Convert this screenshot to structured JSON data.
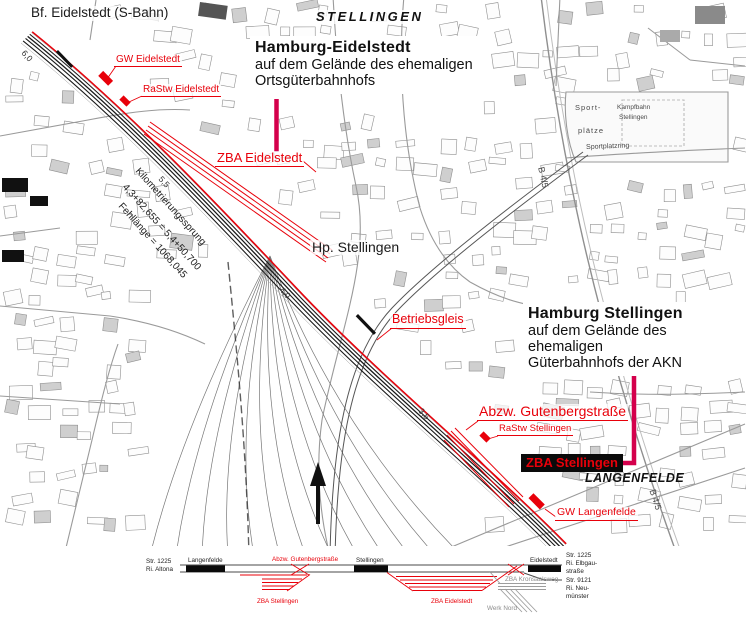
{
  "colors": {
    "red": "#e8000a",
    "crimson": "#d4004c",
    "black": "#1a1a1a",
    "gray": "#8c8c8c"
  },
  "map": {
    "region_labels": {
      "stellingen": "STELLINGEN",
      "langenfelde": "LANGENFELDE"
    },
    "stations": {
      "bf_eidelstedt": "Bf. Eidelstedt (S-Bahn)",
      "hp_stellingen": "Hp. Stellingen"
    },
    "annotations": {
      "eidelstedt": {
        "title": "Hamburg-Eidelstedt",
        "line1": "auf dem Gelände des ehemaligen",
        "line2": "Ortsgüterbahnhofs"
      },
      "stellingen": {
        "title": "Hamburg Stellingen",
        "line1": "auf dem Gelände des ehemaligen",
        "line2": "Güterbahnhofs der AKN"
      }
    },
    "red_labels": {
      "gw_eidelstedt": "GW Eidelstedt",
      "rastw_eidelstedt": "RaStw Eidelstedt",
      "zba_eidelstedt": "ZBA Eidelstedt",
      "betriebsgleis": "Betriebsgleis",
      "abzw_gutenbergstrasse": "Abzw. Gutenbergstraße",
      "rastw_stellingen": "RaStw Stellingen",
      "zba_stellingen": "ZBA Stellingen",
      "gw_langenfelde": "GW Langenfelde"
    },
    "km_note": {
      "line1": "Kilometrierungssprung",
      "line2": "4,3+82,655 = 5,4+50,700",
      "line3": "Fehllänge = 1068,045"
    },
    "km_markers": {
      "m60": "6,0",
      "m55": "5,5",
      "m40": "4,0",
      "m35": "3,5"
    },
    "street_labels": {
      "b45_north": "B 4/5",
      "b45_south": "B 4/5",
      "sport1": "Sport-",
      "sport2": "plätze",
      "kampfbahn1": "Kampfbahn",
      "kampfbahn2": "Stellingen",
      "sportplatzring": "Sportplatzring"
    }
  },
  "diagram": {
    "left_route": {
      "line1": "Str. 1225",
      "line2": "Ri. Altona"
    },
    "stations": {
      "langenfelde": "Langenfelde",
      "stellingen": "Stellingen",
      "eidelstedt": "Eidelstedt"
    },
    "junction": "Abzw. Gutenbergstraße",
    "yards": {
      "zba_stellingen": "ZBA Stellingen",
      "zba_eidelstedt": "ZBA Eidelstedt"
    },
    "sidings": {
      "zba_kronsaalsweg": "ZBA Kronsaalsweg",
      "werk_nord": "Werk Nord"
    },
    "right_routes": {
      "line1": "Str. 1225",
      "line2": "Ri. Elbgau-",
      "line3": "straße",
      "line4": "Str. 9121",
      "line5": "Ri. Neu-",
      "line6": "münster"
    }
  }
}
